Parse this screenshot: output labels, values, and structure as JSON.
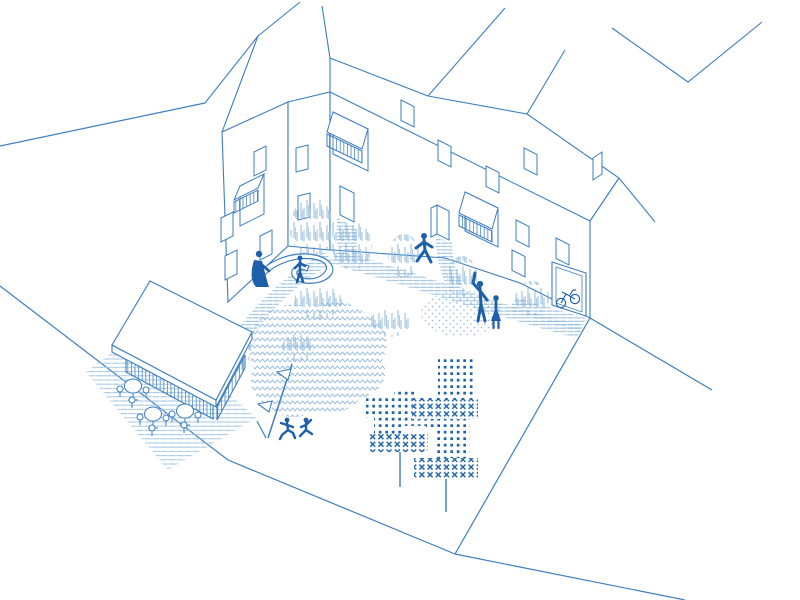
{
  "illustration": {
    "kind": "isometric architectural line drawing",
    "subject": "residential courtyard with row houses, cafe kiosk, trees, paths and people",
    "style": "monochrome blue line art on white"
  },
  "palette": {
    "line": "#3c7ebf",
    "accent": "#1f63a8",
    "figure": "#1d5fa8",
    "hatch": "#86b3da",
    "hatch_light": "#9cc2e2",
    "grass": "#6fa3cf",
    "chevron": "#9dc0e0",
    "dots": "#8fb6d9",
    "plank": "#5d94c6",
    "bg": "#ffffff"
  },
  "scene": {
    "buildings": {
      "wings": 2,
      "plain_windows": 13,
      "awning_balcony_windows": 3,
      "entrance_doors": 2,
      "bike_storage_door": 1,
      "bicycle_parked_in_doorway": true,
      "roof_ridges_running_off_canvas": true
    },
    "kiosk": {
      "roof": "white pitched roof",
      "walls": "vertical plank siding",
      "terrace": "hatched paving",
      "cafe_tables": 3,
      "chairs_per_table": 3
    },
    "courtyard": {
      "hatched_paths": 5,
      "grass_tufts_patches": 9,
      "shrub_meadow_blob": "chevron texture",
      "gravel_area": "fine dot texture",
      "trees": 2,
      "tree_canopy_texture": "dot grid with x-mark bands",
      "flag_pole_pennants": 2,
      "curved_play_bench": 1
    },
    "people": [
      "person sitting at curved bench",
      "child standing at curved bench",
      "person walking near entrance door",
      "person waving",
      "person standing",
      "child running 1",
      "child running 2"
    ],
    "streets": {
      "corner_junction_bottom": true,
      "line_segments": 5
    }
  }
}
